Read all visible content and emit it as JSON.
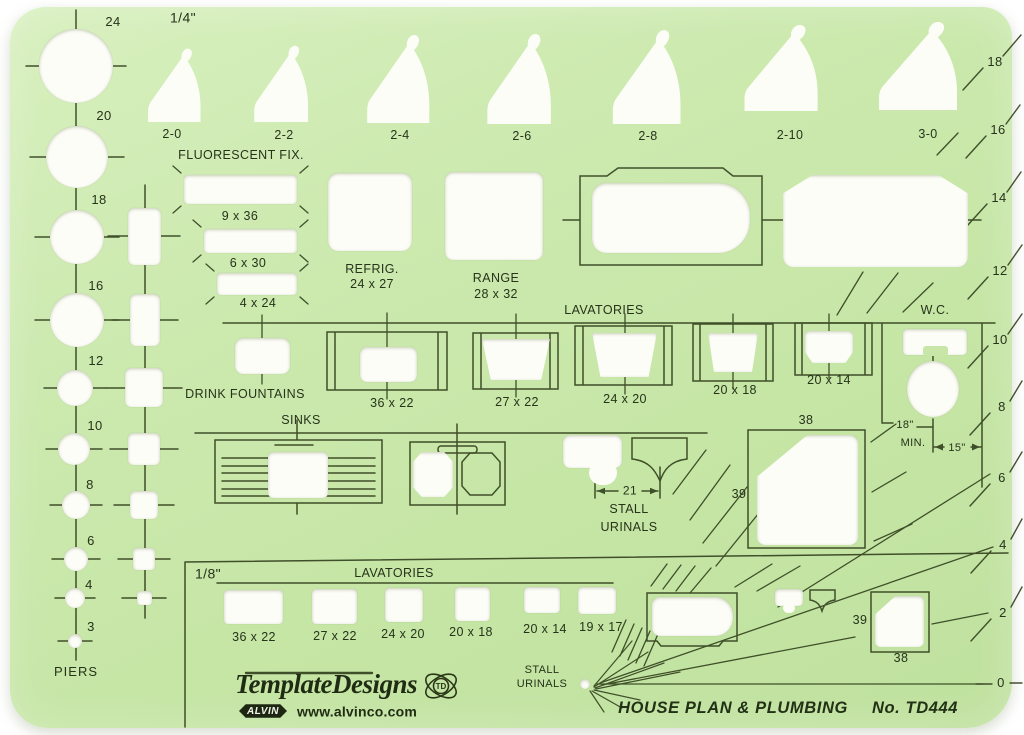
{
  "colors": {
    "plate_green": "#c9e8aa",
    "line_dark": "#34431f",
    "cutout_white": "#fdfdf8"
  },
  "header": {
    "scale_quarter": "1/4\""
  },
  "piers": {
    "label": "PIERS",
    "sizes": [
      "24",
      "20",
      "18",
      "16",
      "12",
      "10",
      "8",
      "6",
      "4",
      "3"
    ]
  },
  "doors": [
    "2-0",
    "2-2",
    "2-4",
    "2-6",
    "2-8",
    "2-10",
    "3-0"
  ],
  "right_scale": [
    "18",
    "16",
    "14",
    "12",
    "10",
    "8",
    "6",
    "4",
    "2",
    "0"
  ],
  "fluorescent": {
    "title": "FLUORESCENT FIX.",
    "sizes": [
      "9 x 36",
      "6 x 30",
      "4 x 24"
    ]
  },
  "appliances": {
    "refrig_name": "REFRIG.",
    "refrig_size": "24 x 27",
    "range_name": "RANGE",
    "range_size": "28 x 32"
  },
  "lavatories_quarter": {
    "title": "LAVATORIES",
    "sizes": [
      "36 x 22",
      "27 x 22",
      "24 x 20",
      "20 x 18",
      "20 x 14"
    ]
  },
  "drink_fountains": {
    "label": "DRINK FOUNTAINS"
  },
  "wc": {
    "label": "W.C.",
    "dim_min": "18\"",
    "dim_min_word": "MIN.",
    "dim_width": "15\""
  },
  "sinks": {
    "label": "SINKS"
  },
  "stall_urinals_quarter": {
    "line1": "STALL",
    "line2": "URINALS",
    "dim": "21"
  },
  "shower_quarter": {
    "size": "38",
    "num": "39"
  },
  "section_eighth": {
    "scale": "1/8\"",
    "lav_title": "LAVATORIES",
    "lav_sizes": [
      "36 x 22",
      "27 x 22",
      "24 x 20",
      "20 x 18",
      "20 x 14",
      "19 x 17"
    ],
    "stall1": "STALL",
    "stall2": "URINALS",
    "shower_size": "38",
    "urinal_num": "39"
  },
  "footer": {
    "brand": "TemplateDesigns",
    "brand_mark": "TD",
    "alvin": "ALVIN",
    "website": "www.alvinco.com",
    "title": "HOUSE PLAN & PLUMBING",
    "model": "No. TD444"
  }
}
